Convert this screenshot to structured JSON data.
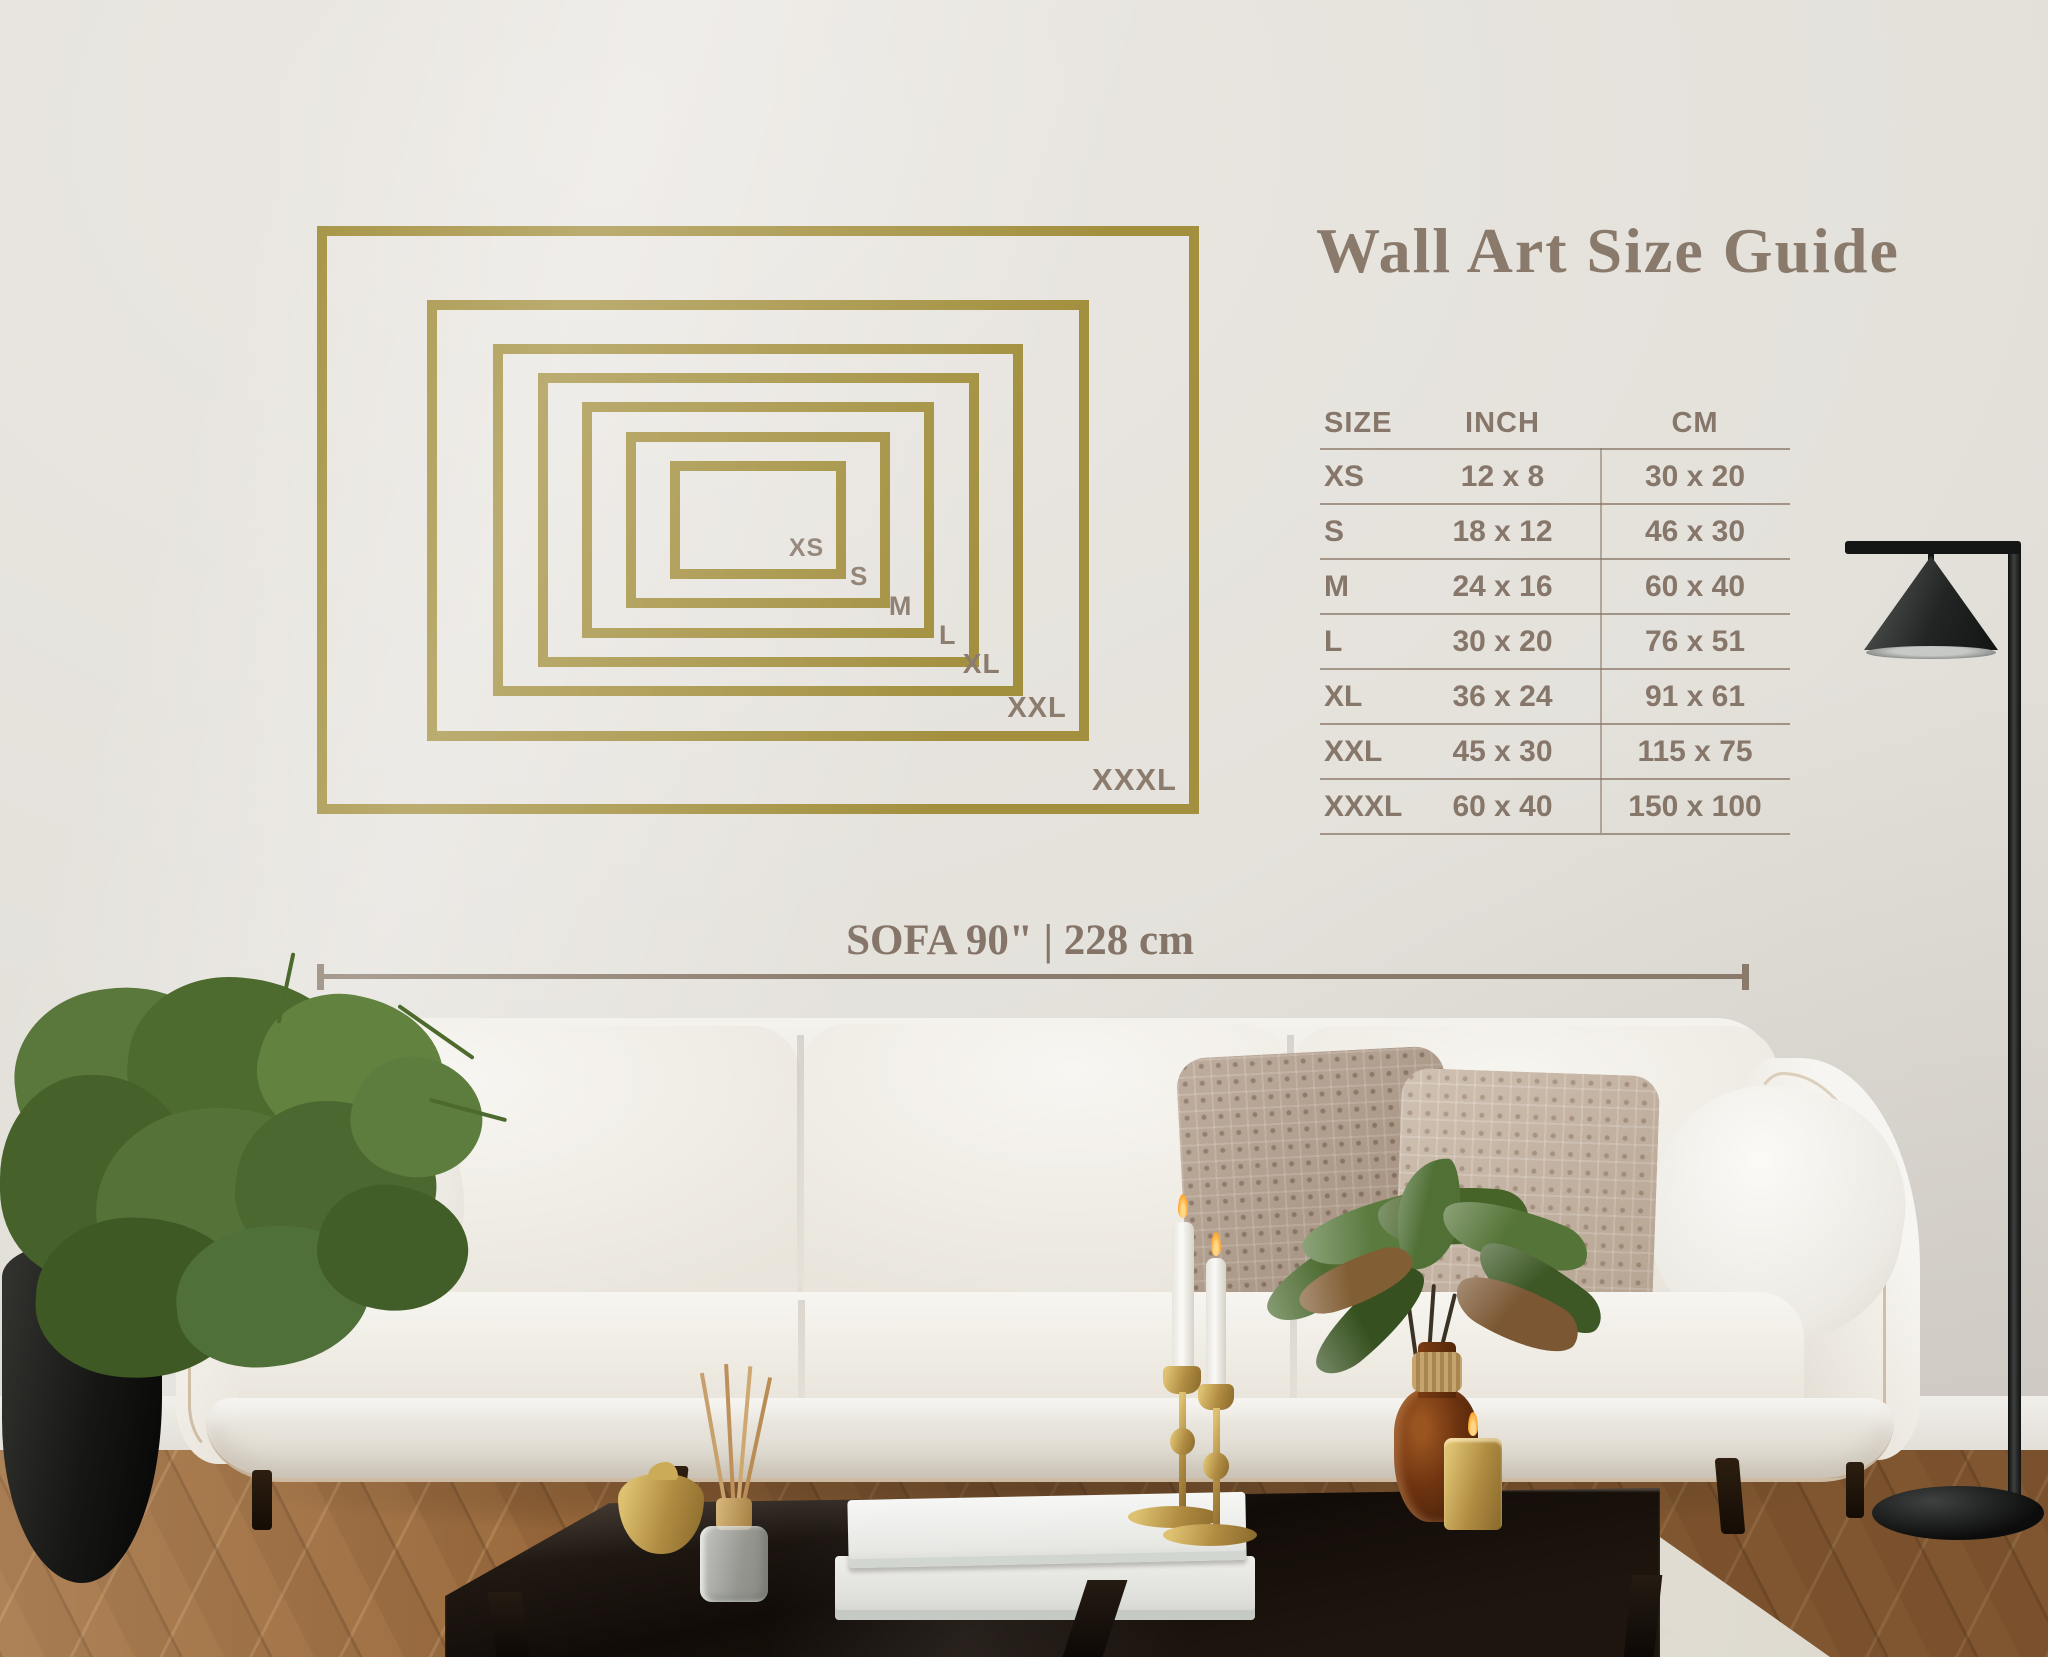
{
  "title": "Wall Art Size Guide",
  "size_chart": {
    "headers": [
      "SIZE",
      "INCH",
      "CM"
    ],
    "rows": [
      {
        "size": "XS",
        "inch": "12 x 8",
        "cm": "30 x 20"
      },
      {
        "size": "S",
        "inch": "18 x 12",
        "cm": "46 x 30"
      },
      {
        "size": "M",
        "inch": "24 x 16",
        "cm": "60 x 40"
      },
      {
        "size": "L",
        "inch": "30 x 20",
        "cm": "76 x 51"
      },
      {
        "size": "XL",
        "inch": "36 x 24",
        "cm": "91 x 61"
      },
      {
        "size": "XXL",
        "inch": "45 x 30",
        "cm": "115 x 75"
      },
      {
        "size": "XXXL",
        "inch": "60 x 40",
        "cm": "150 x 100"
      }
    ]
  },
  "frames": [
    {
      "label": "XS",
      "inch_w": 12,
      "inch_h": 8
    },
    {
      "label": "S",
      "inch_w": 18,
      "inch_h": 12
    },
    {
      "label": "M",
      "inch_w": 24,
      "inch_h": 16
    },
    {
      "label": "L",
      "inch_w": 30,
      "inch_h": 20
    },
    {
      "label": "XL",
      "inch_w": 36,
      "inch_h": 24
    },
    {
      "label": "XXL",
      "inch_w": 45,
      "inch_h": 30
    },
    {
      "label": "XXXL",
      "inch_w": 60,
      "inch_h": 40
    }
  ],
  "sofa_measure": {
    "label": "SOFA 90\" | 228 cm"
  },
  "colors": {
    "frame_gold": "#a3903f",
    "title_text": "#8a7a6c",
    "table_text": "#86776a",
    "label_text": "#8b7c6e",
    "measure_text": "#857569",
    "measure_line": "#8b7b6c"
  }
}
